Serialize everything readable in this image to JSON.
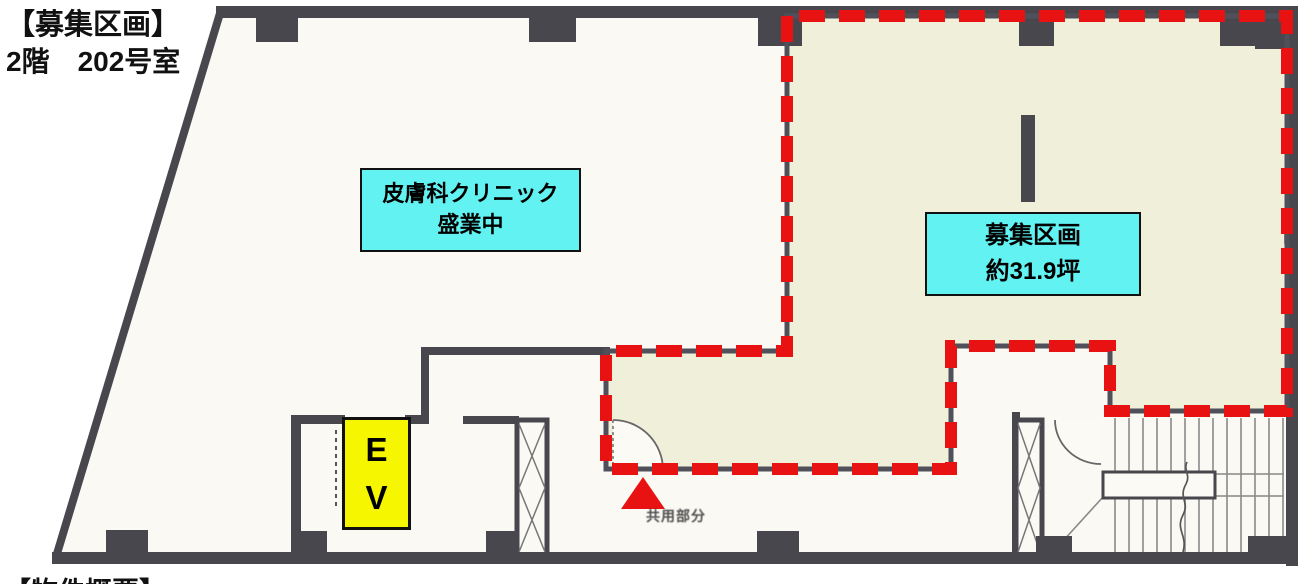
{
  "title": {
    "line1": "【募集区画】",
    "line2": "2階　202号室"
  },
  "clinic_label": {
    "line1": "皮膚科クリニック",
    "line2": "盛業中"
  },
  "vacancy_label": {
    "line1": "募集区画",
    "line2": "約31.9坪"
  },
  "elevator_label": {
    "line1": "E",
    "line2": "V"
  },
  "entrance_note": "共用部分",
  "bottom_caption": "【物件概要】",
  "colors": {
    "highlight_red": "#E91212",
    "vacant_zone_fill": "#F0EFD9",
    "label_cyan": "#63F2F2",
    "elevator_yellow": "#F6F600",
    "wall_gray": "#47474D",
    "floor_white": "#FAF9F4"
  }
}
